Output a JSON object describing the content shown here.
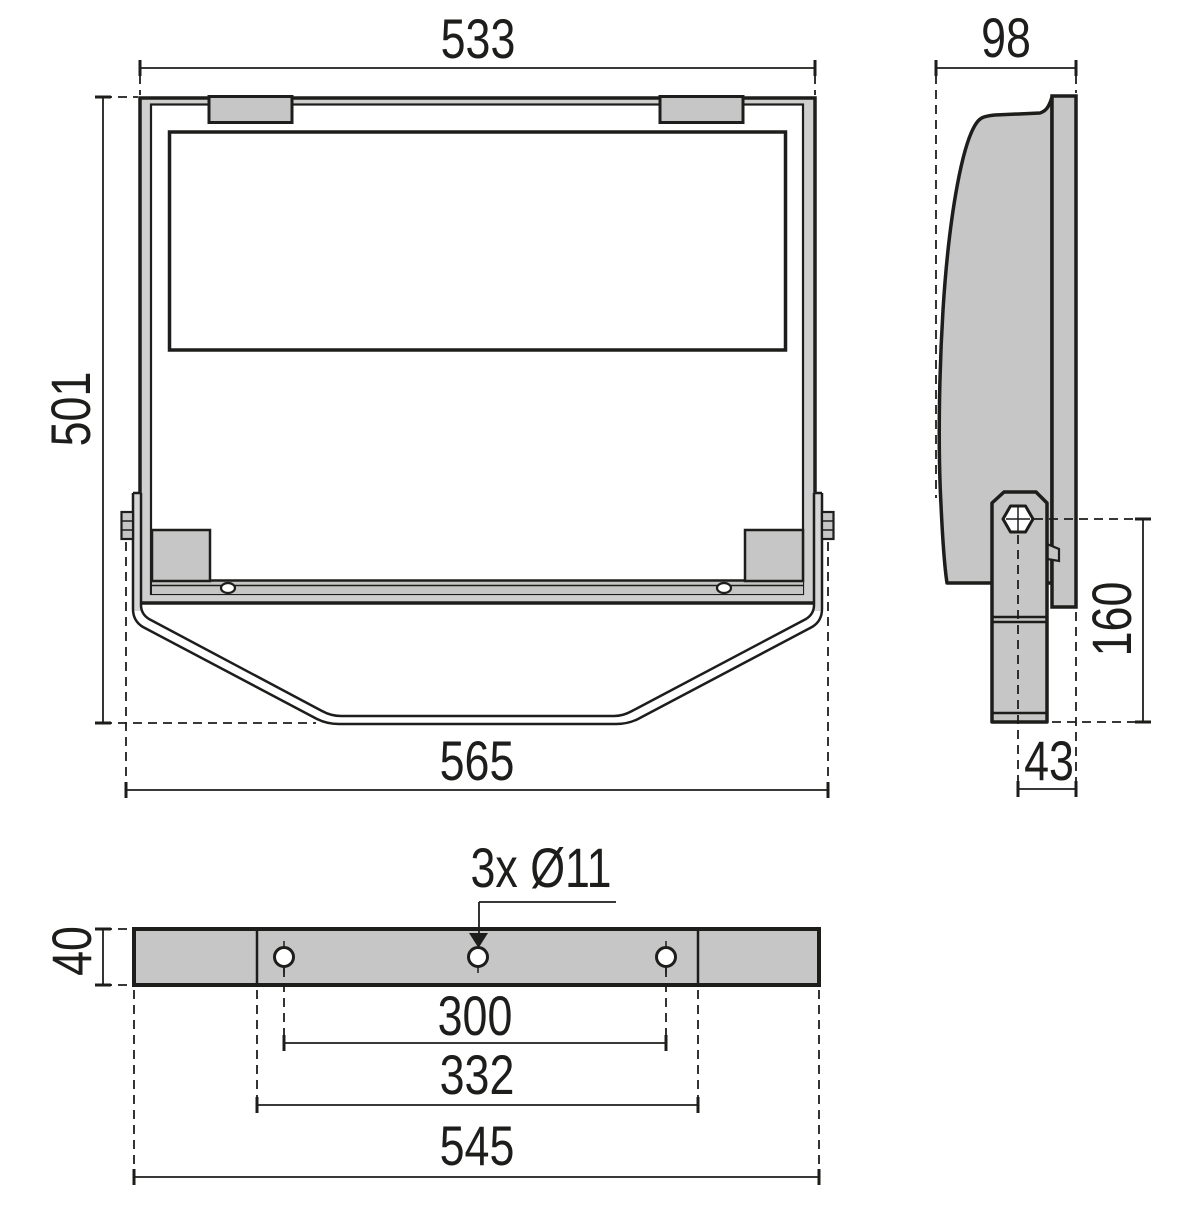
{
  "front": {
    "width_top": "533",
    "height": "501",
    "width_bottom": "565"
  },
  "side": {
    "depth": "98",
    "pivot_to_base": "160",
    "base_offset": "43"
  },
  "bottom": {
    "thickness": "40",
    "hole_callout": "3x Ø11",
    "hole_spacing": "300",
    "inner_spacing": "332",
    "overall_width": "545"
  },
  "colors": {
    "line": "#1d1d1b",
    "fill": "#c6c6c6",
    "wall_fill": "#cfcfcf",
    "background": "#ffffff"
  }
}
